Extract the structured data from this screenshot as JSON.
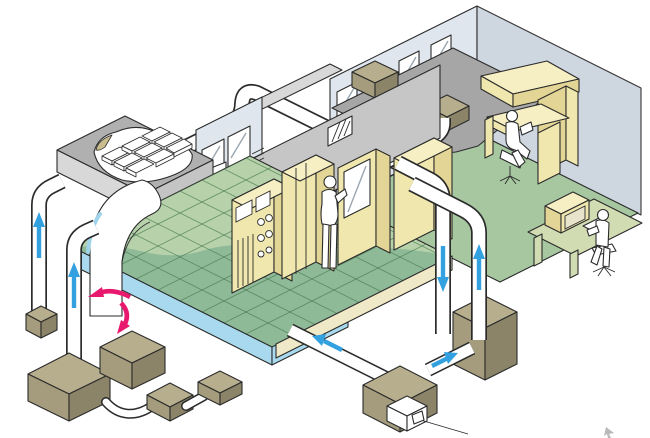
{
  "meta": {
    "title": "Isometric cutaway illustration of a swimming-pool facility with ventilation and heating system",
    "description": "Cutaway isometric drawing: pool hall with gridded water surface and insulated roof, plant room with electrical cabinets and standing worker, office room with desks and seated worker, air ducts with blue flow arrows, pool water circulation pink arrows, tan equipment units (fans, pumps, heat recovery), and an operator at a computer control desk.",
    "canvas_width": 650,
    "canvas_height": 438
  },
  "palette": {
    "outline": "#2b2b2b",
    "white": "#ffffff",
    "roof_top": "#b0b0b0",
    "roof_side": "#d8d8d8",
    "roof_side2": "#c4c4c4",
    "ceiling": "#a6a6a6",
    "wall_light": "#e0e6ed",
    "wall_mid": "#ccd5df",
    "wall_gray": "#c6c6c6",
    "floor_green": "#a6c7a0",
    "deck_green": "#b7d2ab",
    "water_green": "#8fba97",
    "grid_line": "#45784f",
    "pool_blue": "#a9d9ee",
    "accent_blue": "#9fd4ea",
    "cream_step": "#efe9c8",
    "tan_top": "#b6ae8d",
    "tan_left": "#a49c7c",
    "tan_right": "#8c8468",
    "yellow_top": "#f6efc3",
    "yellow_front": "#f0e7ae",
    "yellow_side": "#e2d595",
    "dark_box": "#4f4f4f",
    "dark_box_inner": "#8a8a8a",
    "desk_green": "#d2dcb2",
    "arrow_blue": "#33a1e0",
    "arrow_pink": "#e8186f"
  },
  "scene": {
    "areas": [
      {
        "name": "pool-hall",
        "label": "Pool hall with insulated roof cutaway and gridded water surface"
      },
      {
        "name": "plant-room",
        "label": "Plant room with electrical cabinets and door"
      },
      {
        "name": "office-room",
        "label": "Office room with desks and window wall"
      },
      {
        "name": "basement-plant",
        "label": "Underground plant equipment and duct runs"
      },
      {
        "name": "control-station",
        "label": "Operator control desk with computer"
      }
    ],
    "equipment": [
      "ceiling-unit-1",
      "ceiling-unit-2",
      "roof-insulation-panels",
      "wall-vent-box",
      "supply-duct-large-curved",
      "pool-riser-duct-1",
      "pool-riser-duct-2",
      "office-riser-duct-down",
      "office-riser-duct-up",
      "pump-unit-small",
      "pump-unit-large",
      "pump-unit-mid",
      "pump-unit-a",
      "pump-unit-b",
      "heat-recovery-unit",
      "boiler-unit-with-plug",
      "floor-duct-run",
      "pool-start-block-table"
    ],
    "flows": [
      {
        "name": "pool-riser-1-flow",
        "direction": "up",
        "color": "arrow_blue"
      },
      {
        "name": "pool-riser-2-flow",
        "direction": "up",
        "color": "arrow_blue"
      },
      {
        "name": "office-riser-down-flow",
        "direction": "down",
        "color": "arrow_blue"
      },
      {
        "name": "office-riser-up-flow",
        "direction": "up",
        "color": "arrow_blue"
      },
      {
        "name": "floor-duct-to-pool-flow",
        "direction": "left",
        "color": "arrow_blue"
      },
      {
        "name": "floor-duct-to-unit-flow",
        "direction": "right",
        "color": "arrow_blue"
      },
      {
        "name": "pool-circulation-out",
        "direction": "left",
        "color": "arrow_pink"
      },
      {
        "name": "pool-circulation-down",
        "direction": "down",
        "color": "arrow_pink"
      }
    ],
    "figures": [
      {
        "name": "standing-worker",
        "location": "plant-room doorway"
      },
      {
        "name": "seated-worker",
        "location": "office desk"
      },
      {
        "name": "operator",
        "location": "control desk with computer"
      }
    ]
  }
}
